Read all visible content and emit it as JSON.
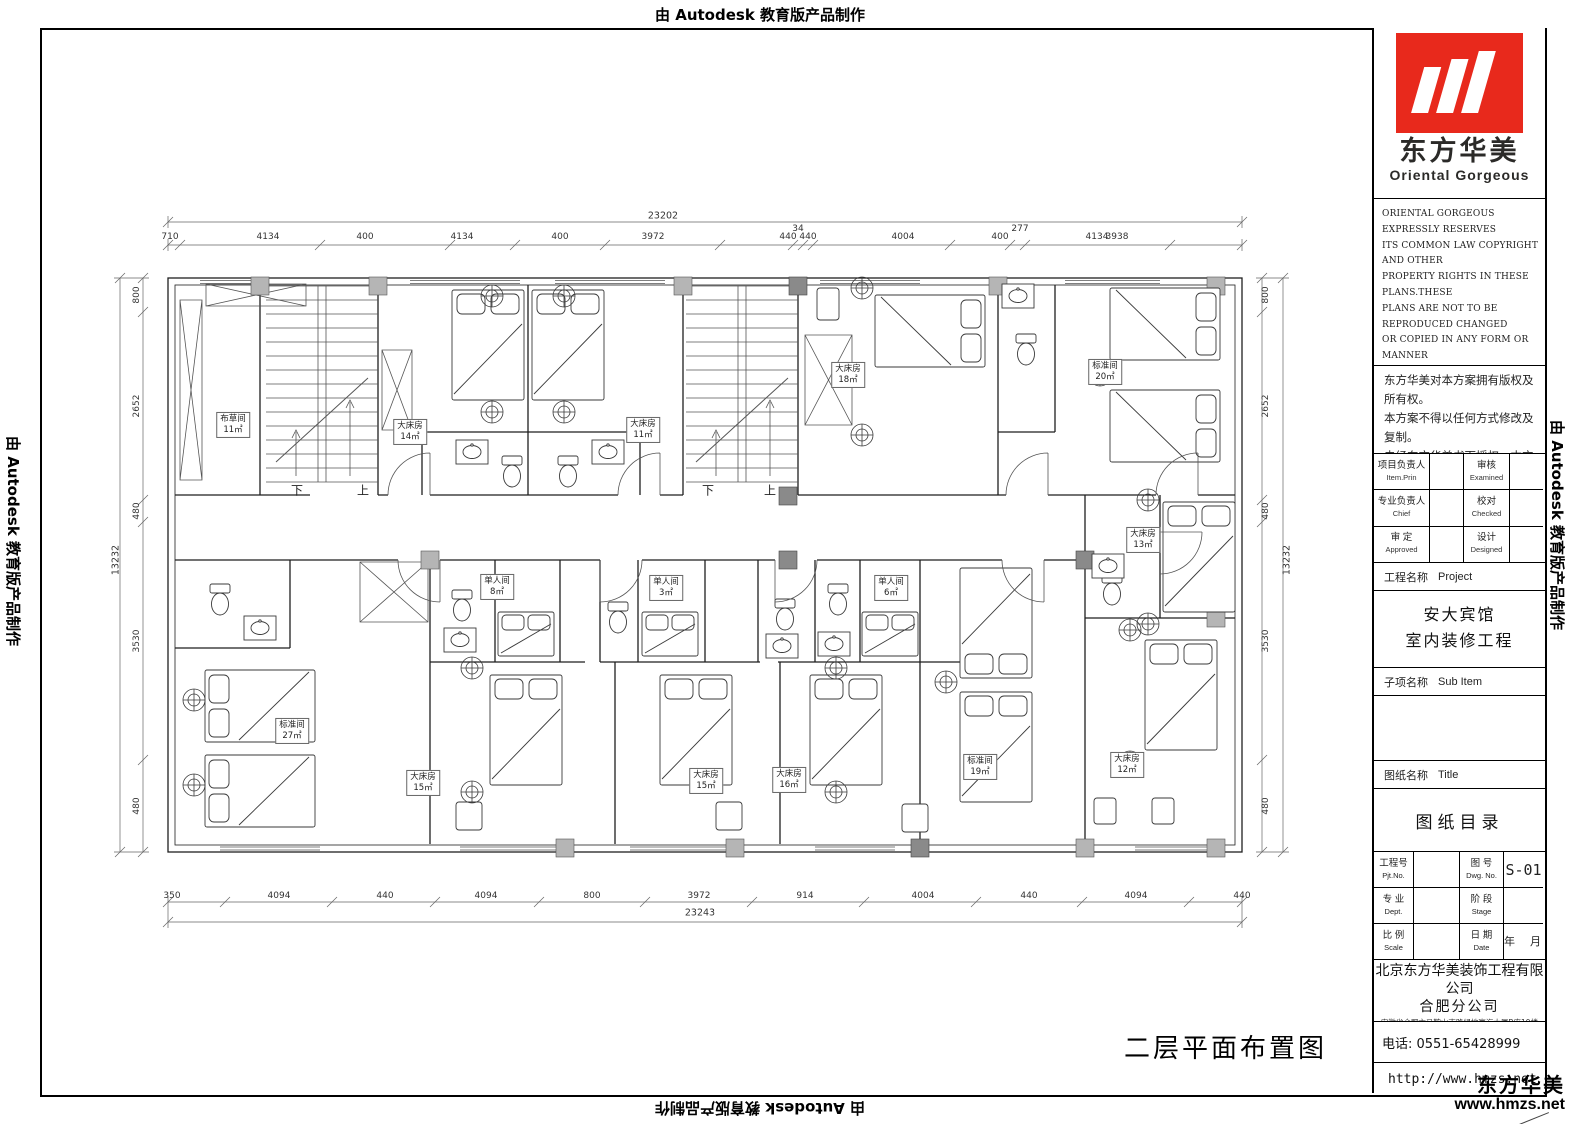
{
  "watermark": {
    "text": "由 Autodesk 教育版产品制作"
  },
  "plan": {
    "title": "二层平面布置图",
    "rooms": [
      {
        "label": "布草间",
        "area": "11㎡"
      },
      {
        "label": "大床房",
        "area": "14㎡"
      },
      {
        "label": "大床房",
        "area": "11㎡"
      },
      {
        "label": "大床房",
        "area": "18㎡"
      },
      {
        "label": "标准间",
        "area": "20㎡"
      },
      {
        "label": "大床房",
        "area": "13㎡"
      },
      {
        "label": "标准间",
        "area": "27㎡"
      },
      {
        "label": "单人间",
        "area": "8㎡"
      },
      {
        "label": "单人间",
        "area": "3㎡"
      },
      {
        "label": "单人间",
        "area": "6㎡"
      },
      {
        "label": "大床房",
        "area": "15㎡"
      },
      {
        "label": "大床房",
        "area": "15㎡"
      },
      {
        "label": "大床房",
        "area": "16㎡"
      },
      {
        "label": "标准间",
        "area": "19㎡"
      },
      {
        "label": "大床房",
        "area": "12㎡"
      }
    ],
    "stair_labels": [
      "下",
      "上",
      "下",
      "上"
    ],
    "dims": {
      "top_overall": "23202",
      "top": [
        "710",
        "4134",
        "400",
        "4134",
        "400",
        "3972",
        "440",
        "34",
        "440",
        "4004",
        "400",
        "277",
        "4134",
        "3938"
      ],
      "bottom_overall": "23243",
      "bottom": [
        "350",
        "4094",
        "440",
        "4094",
        "800",
        "3972",
        "914",
        "4004",
        "440",
        "4094",
        "440"
      ],
      "left_overall": "13232",
      "left": [
        "800",
        "2652",
        "480",
        "3530",
        "480"
      ],
      "right_overall": "13232",
      "right": [
        "800",
        "2652",
        "480",
        "3530",
        "480"
      ]
    }
  },
  "title_block": {
    "brand_cn": "东方华美",
    "brand_en": "Oriental Gorgeous",
    "logo_color": "#e8291c",
    "copyright_en_lines": [
      "ORIENTAL GORGEOUS EXPRESSLY RESERVES",
      "ITS COMMON LAW COPYRIGHT AND OTHER",
      "PROPERTY RIGHTS IN THESE PLANS.THESE",
      "PLANS ARE NOT TO BE REPRODUCED CHANGED",
      "OR COPIED IN ANY FORM OR MANNER",
      "WHATSOEVER,NOR ARE THEY TO BE ASSIGNED",
      "TO ANY THIRD PARTY WITHOUT FIRST",
      "OBTAINING THE EXPRESSED WRITTEN",
      "PERMISSION AND CONSENT OF ORIENTAL",
      "GORGEOUS"
    ],
    "copyright_cn_lines": [
      "东方华美对本方案拥有版权及所有权。",
      "本方案不得以任何方式修改及复制。",
      "未经东方华美书面授权，本方案不得向",
      "任何第三方转让。"
    ],
    "fields": {
      "item_prin_cn": "项目负责人",
      "item_prin_en": "Item.Prin",
      "examined_cn": "审核",
      "examined_en": "Examined",
      "chief_cn": "专业负责人",
      "chief_en": "Chief",
      "checked_cn": "校对",
      "checked_en": "Checked",
      "approved_cn": "审 定",
      "approved_en": "Approved",
      "designed_cn": "设计",
      "designed_en": "Designed"
    },
    "project_label_cn": "工程名称",
    "project_label_en": "Project",
    "project_name_line1": "安大宾馆",
    "project_name_line2": "室内装修工程",
    "subitem_label_cn": "子项名称",
    "subitem_label_en": "Sub Item",
    "sheet_label_cn": "图纸名称",
    "sheet_label_en": "Title",
    "sheet_name": "图纸目录",
    "grid": {
      "pjt_cn": "工程号",
      "pjt_en": "Pjt.No.",
      "dwg_cn": "图 号",
      "dwg_en": "Dwg. No.",
      "dwg_no": "S-01",
      "dept_cn": "专 业",
      "dept_en": "Dept.",
      "stage_cn": "阶 段",
      "stage_en": "Stage",
      "scale_cn": "比 例",
      "scale_en": "Scale",
      "date_cn": "日 期",
      "date_en": "Date",
      "date_value": "年　月"
    },
    "company_line1": "北京东方华美装饰工程有限公司",
    "company_line2": "合肥分公司",
    "company_address": "安徽省合肥市马鞍山南路绿地赢海大厦B座19楼",
    "phone": "电话: 0551-65428999",
    "website": "http://www.hmzs.net",
    "footer_brand": "东方华美",
    "footer_url": "www.hmzs.net"
  }
}
